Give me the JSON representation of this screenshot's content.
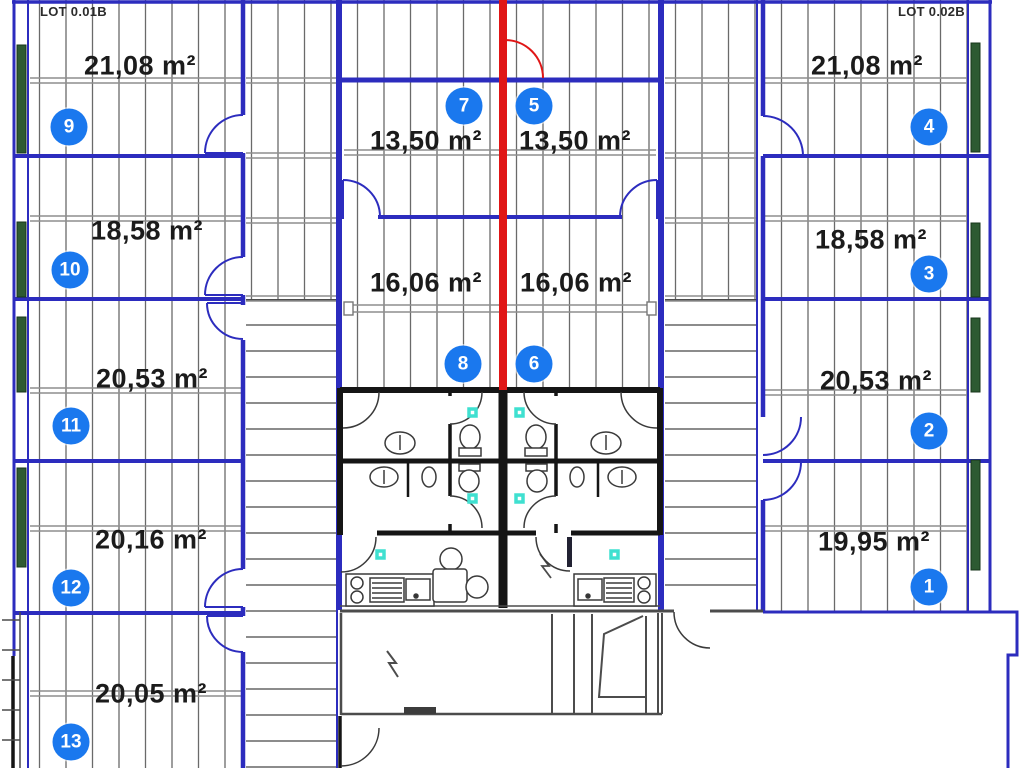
{
  "plan": {
    "lots": {
      "left": "LOT 0.01B",
      "right": "LOT 0.02B"
    },
    "rooms": {
      "r1": {
        "marker": "1",
        "area": "19,95 m²"
      },
      "r2": {
        "marker": "2",
        "area": "20,53 m²"
      },
      "r3": {
        "marker": "3",
        "area": "18,58 m²"
      },
      "r4": {
        "marker": "4",
        "area": "21,08 m²"
      },
      "r5": {
        "marker": "5",
        "area": "13,50 m²"
      },
      "r6": {
        "marker": "6",
        "area": "16,06 m²"
      },
      "r7": {
        "marker": "7",
        "area": "13,50 m²"
      },
      "r8": {
        "marker": "8",
        "area": "16,06 m²"
      },
      "r9": {
        "marker": "9",
        "area": "21,08 m²"
      },
      "r10": {
        "marker": "10",
        "area": "18,58 m²"
      },
      "r11": {
        "marker": "11",
        "area": "20,53 m²"
      },
      "r12": {
        "marker": "12",
        "area": "20,16 m²"
      },
      "r13": {
        "marker": "13",
        "area": "20,05 m²"
      }
    },
    "colors": {
      "wall_blue": "#2c2cbe",
      "marker_blue": "#1a78ee",
      "divider_red": "#e01616",
      "window_green": "#2d5a32",
      "switch_cyan": "#3fe0d0"
    }
  }
}
